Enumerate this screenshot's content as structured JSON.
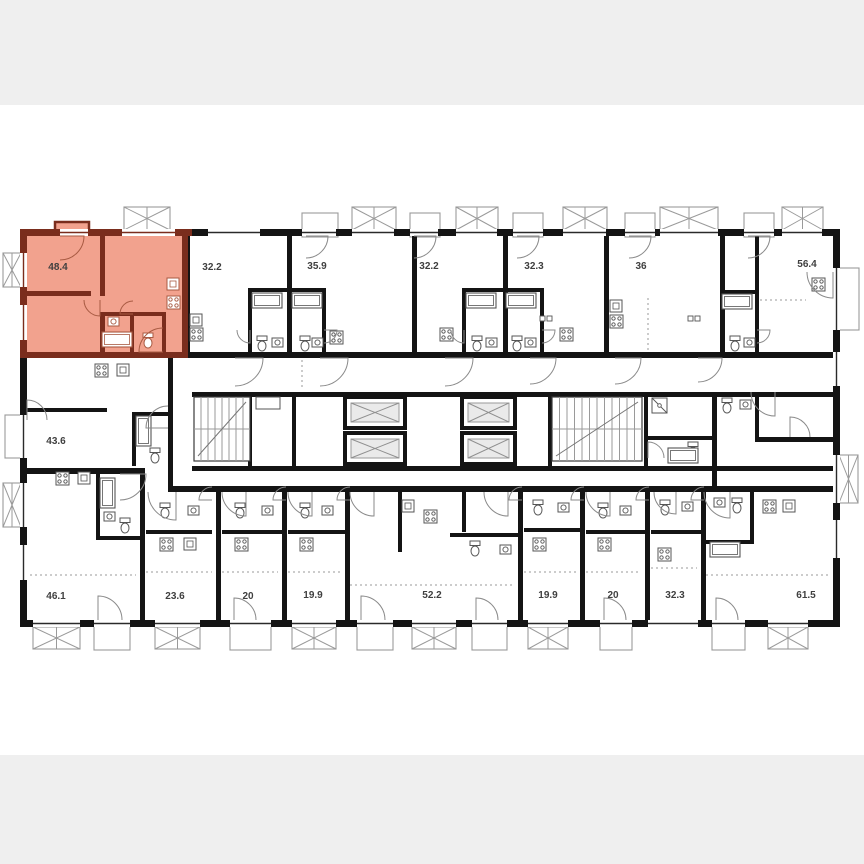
{
  "page": {
    "band_color": "#efefef",
    "canvas_color": "#ffffff"
  },
  "plan": {
    "wall_color": "#141414",
    "line_color": "#8a8a8a",
    "fixture_color": "#555555",
    "highlight": {
      "fill": "#f2a28e",
      "wall": "#7a2d1d",
      "accent": "#a85a42"
    },
    "icons": {
      "elevator": "crossed-box-icon",
      "stairs": "stair-treads-icon",
      "balcony": "crossed-box-icon",
      "bathtub": "bathtub-icon",
      "toilet": "toilet-icon",
      "sink": "sink-icon",
      "stove": "stove-icon",
      "door": "door-swing-icon"
    },
    "apartments": [
      {
        "row": "top",
        "area": "48.4",
        "highlighted": true
      },
      {
        "row": "top",
        "area": "32.2",
        "highlighted": false
      },
      {
        "row": "top",
        "area": "35.9",
        "highlighted": false
      },
      {
        "row": "top",
        "area": "32.2",
        "highlighted": false
      },
      {
        "row": "top",
        "area": "32.3",
        "highlighted": false
      },
      {
        "row": "top",
        "area": "36",
        "highlighted": false
      },
      {
        "row": "top",
        "area": "56.4",
        "highlighted": false
      },
      {
        "row": "left",
        "area": "43.6",
        "highlighted": false
      },
      {
        "row": "bottom",
        "area": "46.1",
        "highlighted": false
      },
      {
        "row": "bottom",
        "area": "23.6",
        "highlighted": false
      },
      {
        "row": "bottom",
        "area": "20",
        "highlighted": false
      },
      {
        "row": "bottom",
        "area": "19.9",
        "highlighted": false
      },
      {
        "row": "bottom",
        "area": "52.2",
        "highlighted": false
      },
      {
        "row": "bottom",
        "area": "19.9",
        "highlighted": false
      },
      {
        "row": "bottom",
        "area": "20",
        "highlighted": false
      },
      {
        "row": "bottom",
        "area": "32.3",
        "highlighted": false
      },
      {
        "row": "bottom",
        "area": "61.5",
        "highlighted": false
      }
    ]
  }
}
